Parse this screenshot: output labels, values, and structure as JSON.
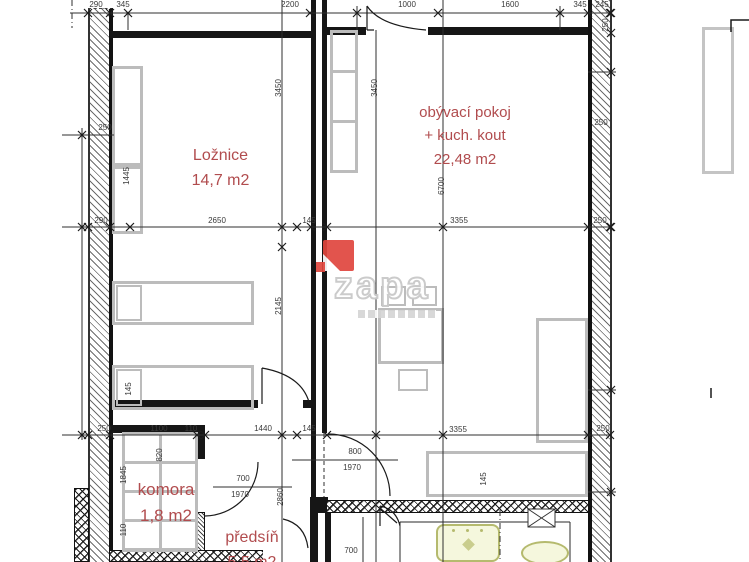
{
  "document": {
    "type": "architectural floor plan"
  },
  "rooms": {
    "loznice": {
      "name": "Ložnice",
      "area": "14,7 m2"
    },
    "obyvaci": {
      "name": "obývací pokoj",
      "name2": "+ kuch. kout",
      "area": "22,48 m2"
    },
    "komora": {
      "name": "komora",
      "area": "1,8 m2"
    },
    "predsin": {
      "name": "předsíň",
      "area": "5,5 m2"
    }
  },
  "watermark": {
    "text": "zapa",
    "logo_color": "#e0463e",
    "outline_color": "#c9c9c9"
  },
  "colors": {
    "room_label": "#b14c4e",
    "wall": "#161616",
    "furniture": "#bcbcbc",
    "dimension_text": "#3a3a3a",
    "fixture_fill": "#f5f7dd",
    "fixture_border": "#b5ba6e"
  },
  "dim_labels": [
    {
      "t": "290",
      "x": 96,
      "y": 5
    },
    {
      "t": "345",
      "x": 123,
      "y": 5
    },
    {
      "t": "2200",
      "x": 290,
      "y": 5
    },
    {
      "t": "1000",
      "x": 407,
      "y": 5
    },
    {
      "t": "1600",
      "x": 510,
      "y": 5
    },
    {
      "t": "345",
      "x": 580,
      "y": 5
    },
    {
      "t": "245",
      "x": 602,
      "y": 5
    },
    {
      "t": "250",
      "x": 105,
      "y": 128
    },
    {
      "t": "250",
      "x": 601,
      "y": 123
    },
    {
      "t": "250",
      "x": 606,
      "y": 25,
      "r": 1
    },
    {
      "t": "290",
      "x": 101,
      "y": 221
    },
    {
      "t": "2650",
      "x": 217,
      "y": 221
    },
    {
      "t": "145",
      "x": 309,
      "y": 221
    },
    {
      "t": "3355",
      "x": 459,
      "y": 221
    },
    {
      "t": "250",
      "x": 600,
      "y": 221
    },
    {
      "t": "250",
      "x": 104,
      "y": 429
    },
    {
      "t": "1100",
      "x": 159,
      "y": 429
    },
    {
      "t": "110",
      "x": 191,
      "y": 429
    },
    {
      "t": "1440",
      "x": 263,
      "y": 429
    },
    {
      "t": "145",
      "x": 309,
      "y": 429
    },
    {
      "t": "3355",
      "x": 458,
      "y": 430
    },
    {
      "t": "250",
      "x": 603,
      "y": 429
    },
    {
      "t": "3450",
      "x": 279,
      "y": 88,
      "r": 1
    },
    {
      "t": "3450",
      "x": 375,
      "y": 88,
      "r": 1
    },
    {
      "t": "6700",
      "x": 442,
      "y": 186,
      "r": 1
    },
    {
      "t": "2145",
      "x": 279,
      "y": 306,
      "r": 1
    },
    {
      "t": "2860",
      "x": 281,
      "y": 497,
      "r": 1
    },
    {
      "t": "1445",
      "x": 127,
      "y": 176,
      "r": 1
    },
    {
      "t": "145",
      "x": 129,
      "y": 389,
      "r": 1
    },
    {
      "t": "1845",
      "x": 124,
      "y": 475,
      "r": 1
    },
    {
      "t": "820",
      "x": 160,
      "y": 455,
      "r": 1
    },
    {
      "t": "110",
      "x": 124,
      "y": 530,
      "r": 1
    },
    {
      "t": "145",
      "x": 484,
      "y": 479,
      "r": 1
    },
    {
      "t": "800",
      "x": 355,
      "y": 452
    },
    {
      "t": "1970",
      "x": 352,
      "y": 468
    },
    {
      "t": "700",
      "x": 243,
      "y": 479
    },
    {
      "t": "1970",
      "x": 240,
      "y": 495
    },
    {
      "t": "700",
      "x": 351,
      "y": 551
    }
  ]
}
